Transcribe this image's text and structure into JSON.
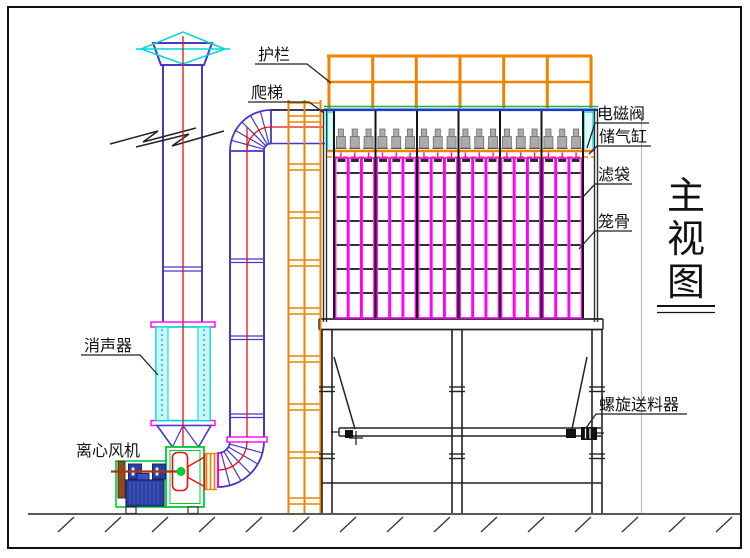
{
  "drawing": {
    "labels": {
      "guardrail": "护栏",
      "ladder": "爬梯",
      "solenoid_valve": "电磁阀",
      "air_reservoir": "储气缸",
      "filter_bag": "滤袋",
      "bag_cage": "笼骨",
      "silencer": "消声器",
      "centrifugal_fan": "离心风机",
      "screw_feeder": "螺旋送料器"
    },
    "view_title": {
      "char_1": "主",
      "char_2": "视",
      "char_3": "图"
    },
    "equipment": {
      "compartments": 6,
      "valves_per_compartment": 3,
      "filter_bag_count": 18,
      "pulse_valve_count": 18,
      "cage_rings_per_bag": 6
    },
    "colors": {
      "railing_orange": "#f08200",
      "bag_magenta": "#ff00ff",
      "duct_blue": "#4638c8",
      "silencer_cyan": "#00d5d5",
      "silencer_fill": "#c9f7f7",
      "fan_green": "#00cc33",
      "centerline_red": "#e81010",
      "motor_blue": "#2a3fa0",
      "motor_dark": "#16246b",
      "shaft_brown": "#b03010",
      "pulley_brown": "#8a4b20",
      "structure_black": "#222222",
      "valve_gray": "#ababab",
      "roof_green": "#00bb33",
      "roof_blue": "#2238c8"
    }
  }
}
